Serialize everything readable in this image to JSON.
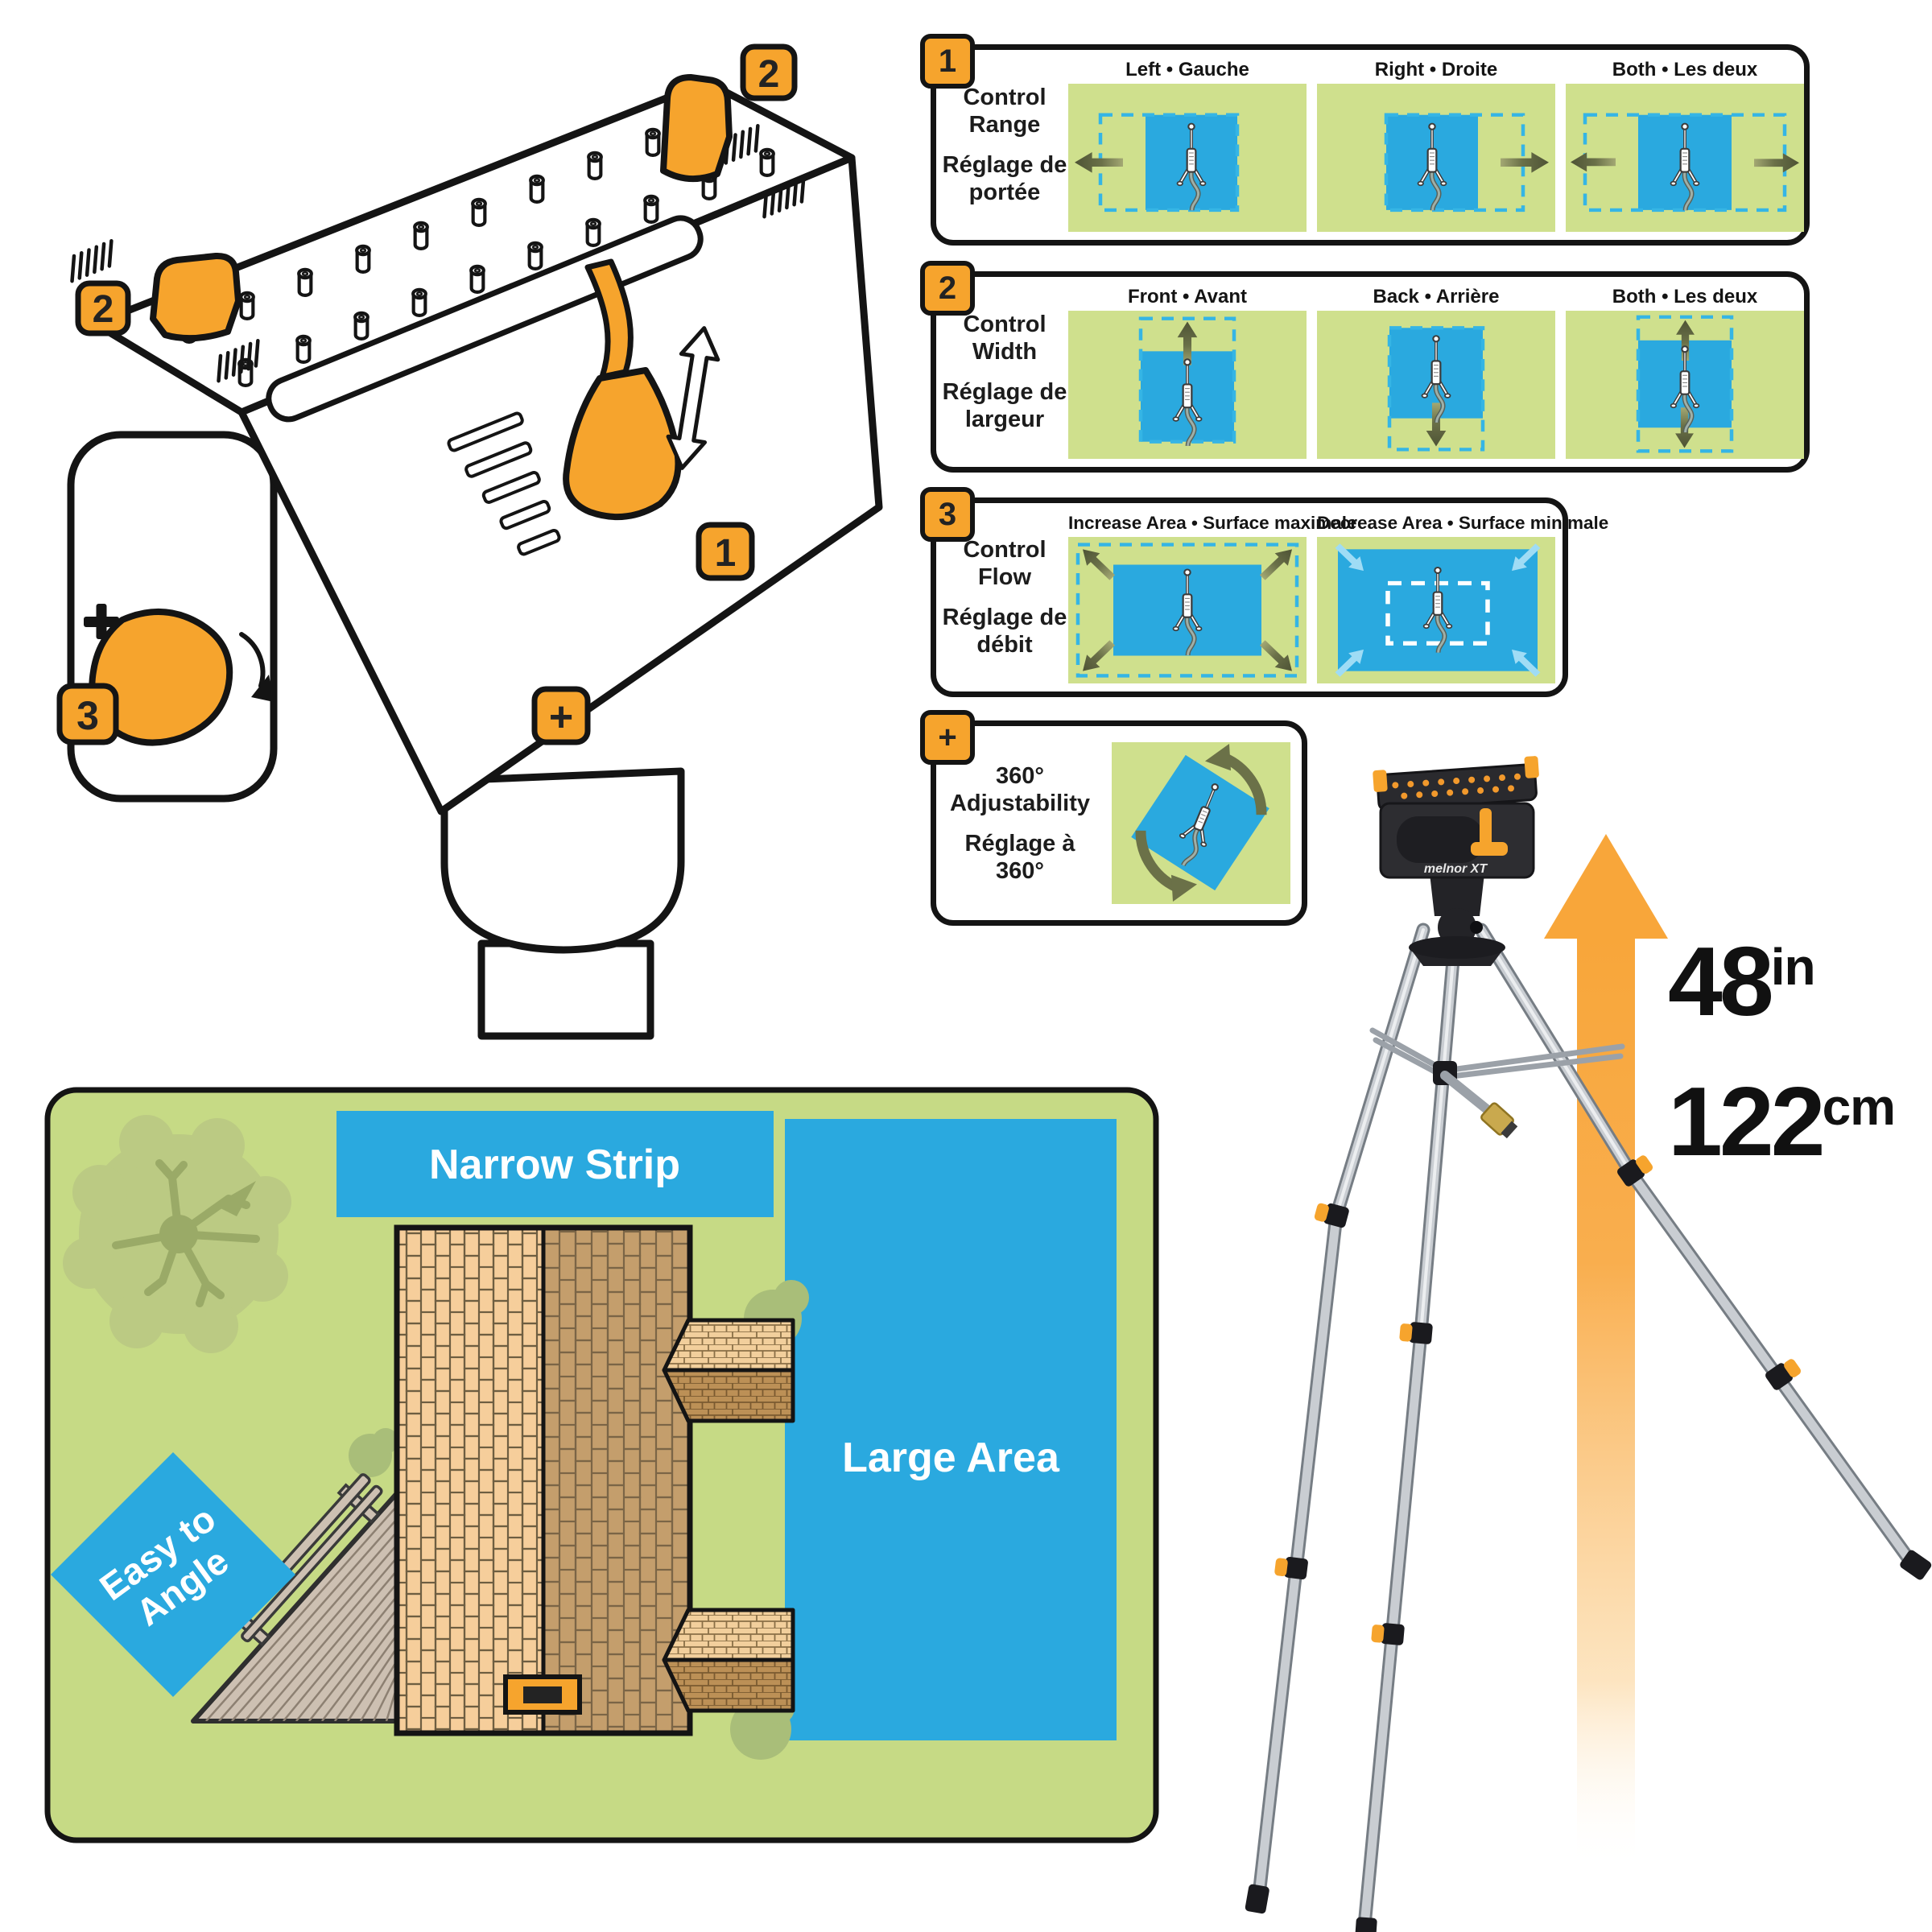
{
  "device": {
    "badge_range_right": "2",
    "badge_range_left": "2",
    "badge_flow": "1",
    "badge_width": "3",
    "badge_rotate": "+",
    "plus_marking": "+"
  },
  "panels": [
    {
      "badge": "1",
      "label_en": "Control Range",
      "label_fr": "Réglage de portée",
      "cells": [
        {
          "header": "Left • Gauche"
        },
        {
          "header": "Right • Droite"
        },
        {
          "header": "Both • Les deux"
        }
      ]
    },
    {
      "badge": "2",
      "label_en": "Control Width",
      "label_fr": "Réglage de largeur",
      "cells": [
        {
          "header": "Front • Avant"
        },
        {
          "header": "Back • Arrière"
        },
        {
          "header": "Both • Les deux"
        }
      ]
    },
    {
      "badge": "3",
      "label_en": "Control Flow",
      "label_fr": "Réglage de débit",
      "cells": [
        {
          "header": "Increase Area • Surface maximale"
        },
        {
          "header": "Decrease Area • Surface minimale"
        }
      ]
    },
    {
      "badge": "+",
      "label_en": "360° Adjustability",
      "label_fr": "Réglage à 360°",
      "cells": [
        {
          "header": ""
        }
      ]
    }
  ],
  "yard": {
    "narrow_strip": "Narrow Strip",
    "large_area": "Large Area",
    "easy_to_angle_line1": "Easy to",
    "easy_to_angle_line2": "Angle"
  },
  "tripod": {
    "brand": "melnor XT",
    "height_in": "48",
    "unit_in": "in",
    "height_cm": "122",
    "unit_cm": "cm"
  },
  "colors": {
    "accent_orange": "#F6A42D",
    "diagram_green": "#CFE08D",
    "yard_green": "#C6DA85",
    "water_blue": "#2AA9DF",
    "dash_blue": "#35B5E5",
    "olive_arrow": "#5C6142",
    "light_blue_arrow": "#9FDCF5",
    "outline_black": "#141414"
  }
}
